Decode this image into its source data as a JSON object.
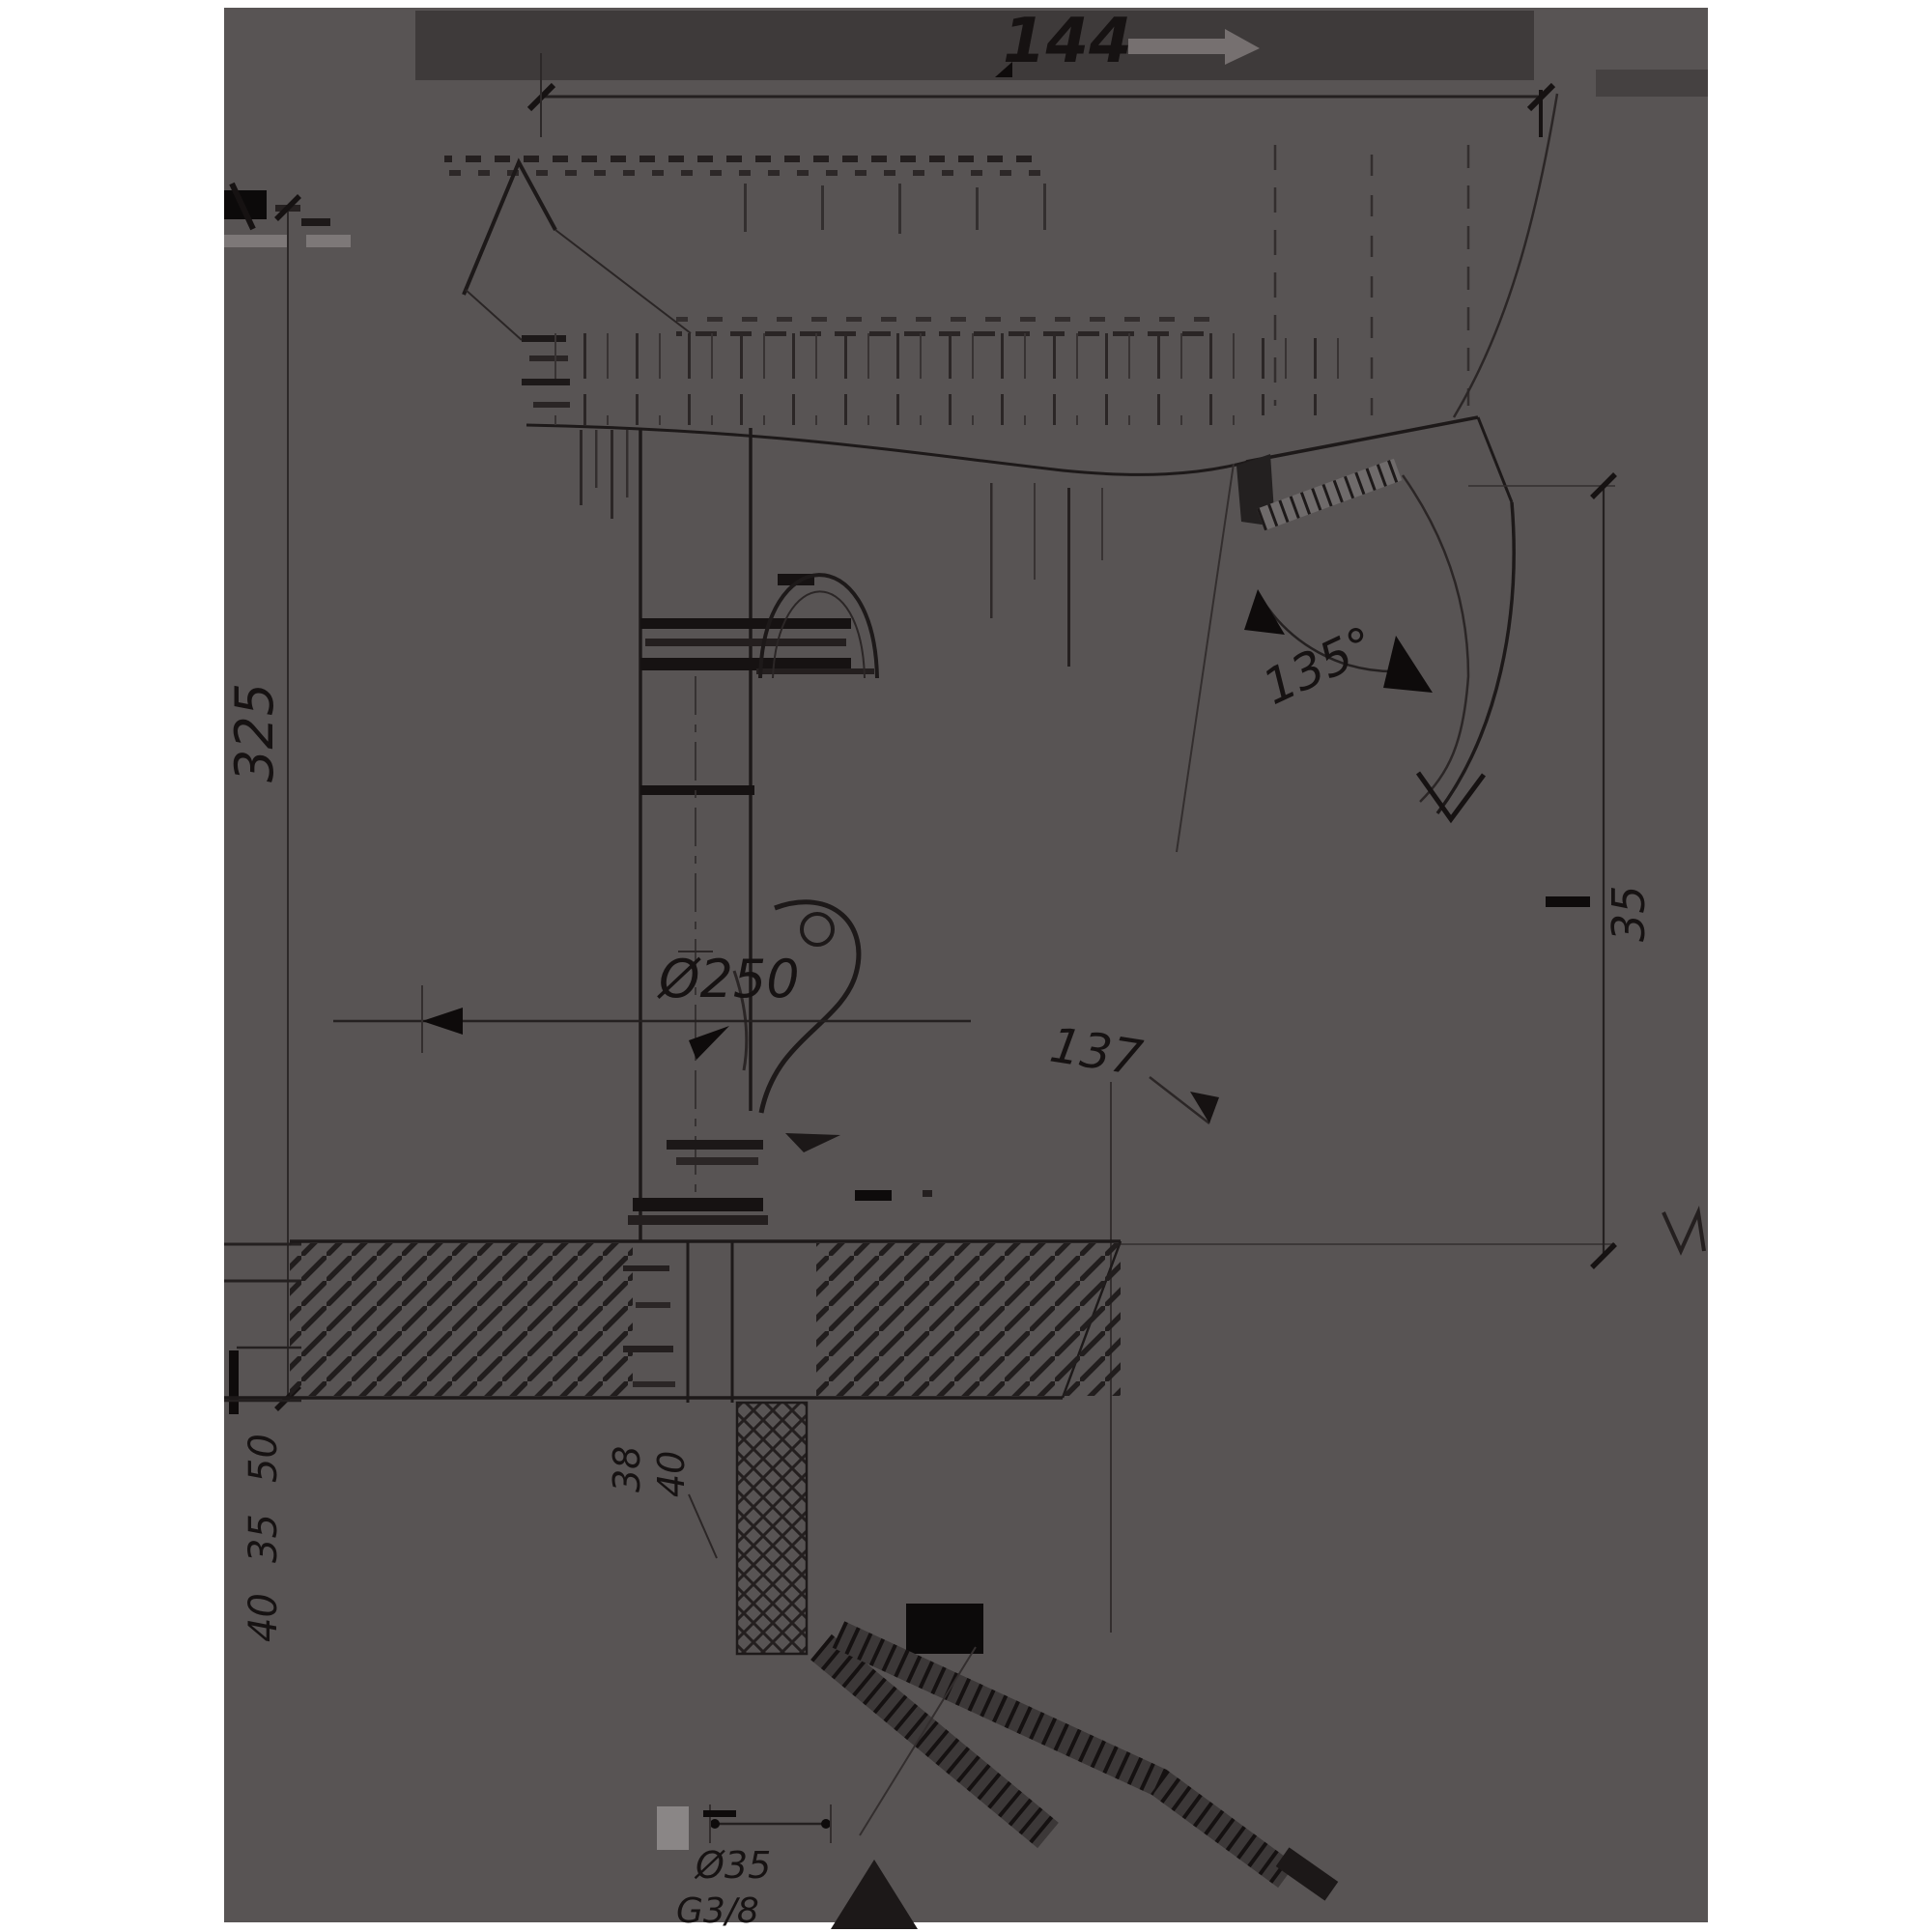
{
  "drawing": {
    "title": "faucet-dimension-drawing",
    "labels": {
      "top_width": "144",
      "overall_height": "325",
      "swivel_angle": "135°",
      "right_height": "35",
      "base_diameter": "Ø250",
      "spout_reach": "137",
      "left_stack": [
        "50",
        "35",
        "40"
      ],
      "shank_stack": [
        "38",
        "40"
      ],
      "bottom_hole": "Ø35",
      "bottom_thread": "G3/8"
    },
    "colors": {
      "page": "#ffffff",
      "plate": "#585454",
      "top_band": "#3e3a3a",
      "ink": "#161212",
      "hatch": "#221e1e",
      "light_mark": "#7d7878"
    }
  }
}
